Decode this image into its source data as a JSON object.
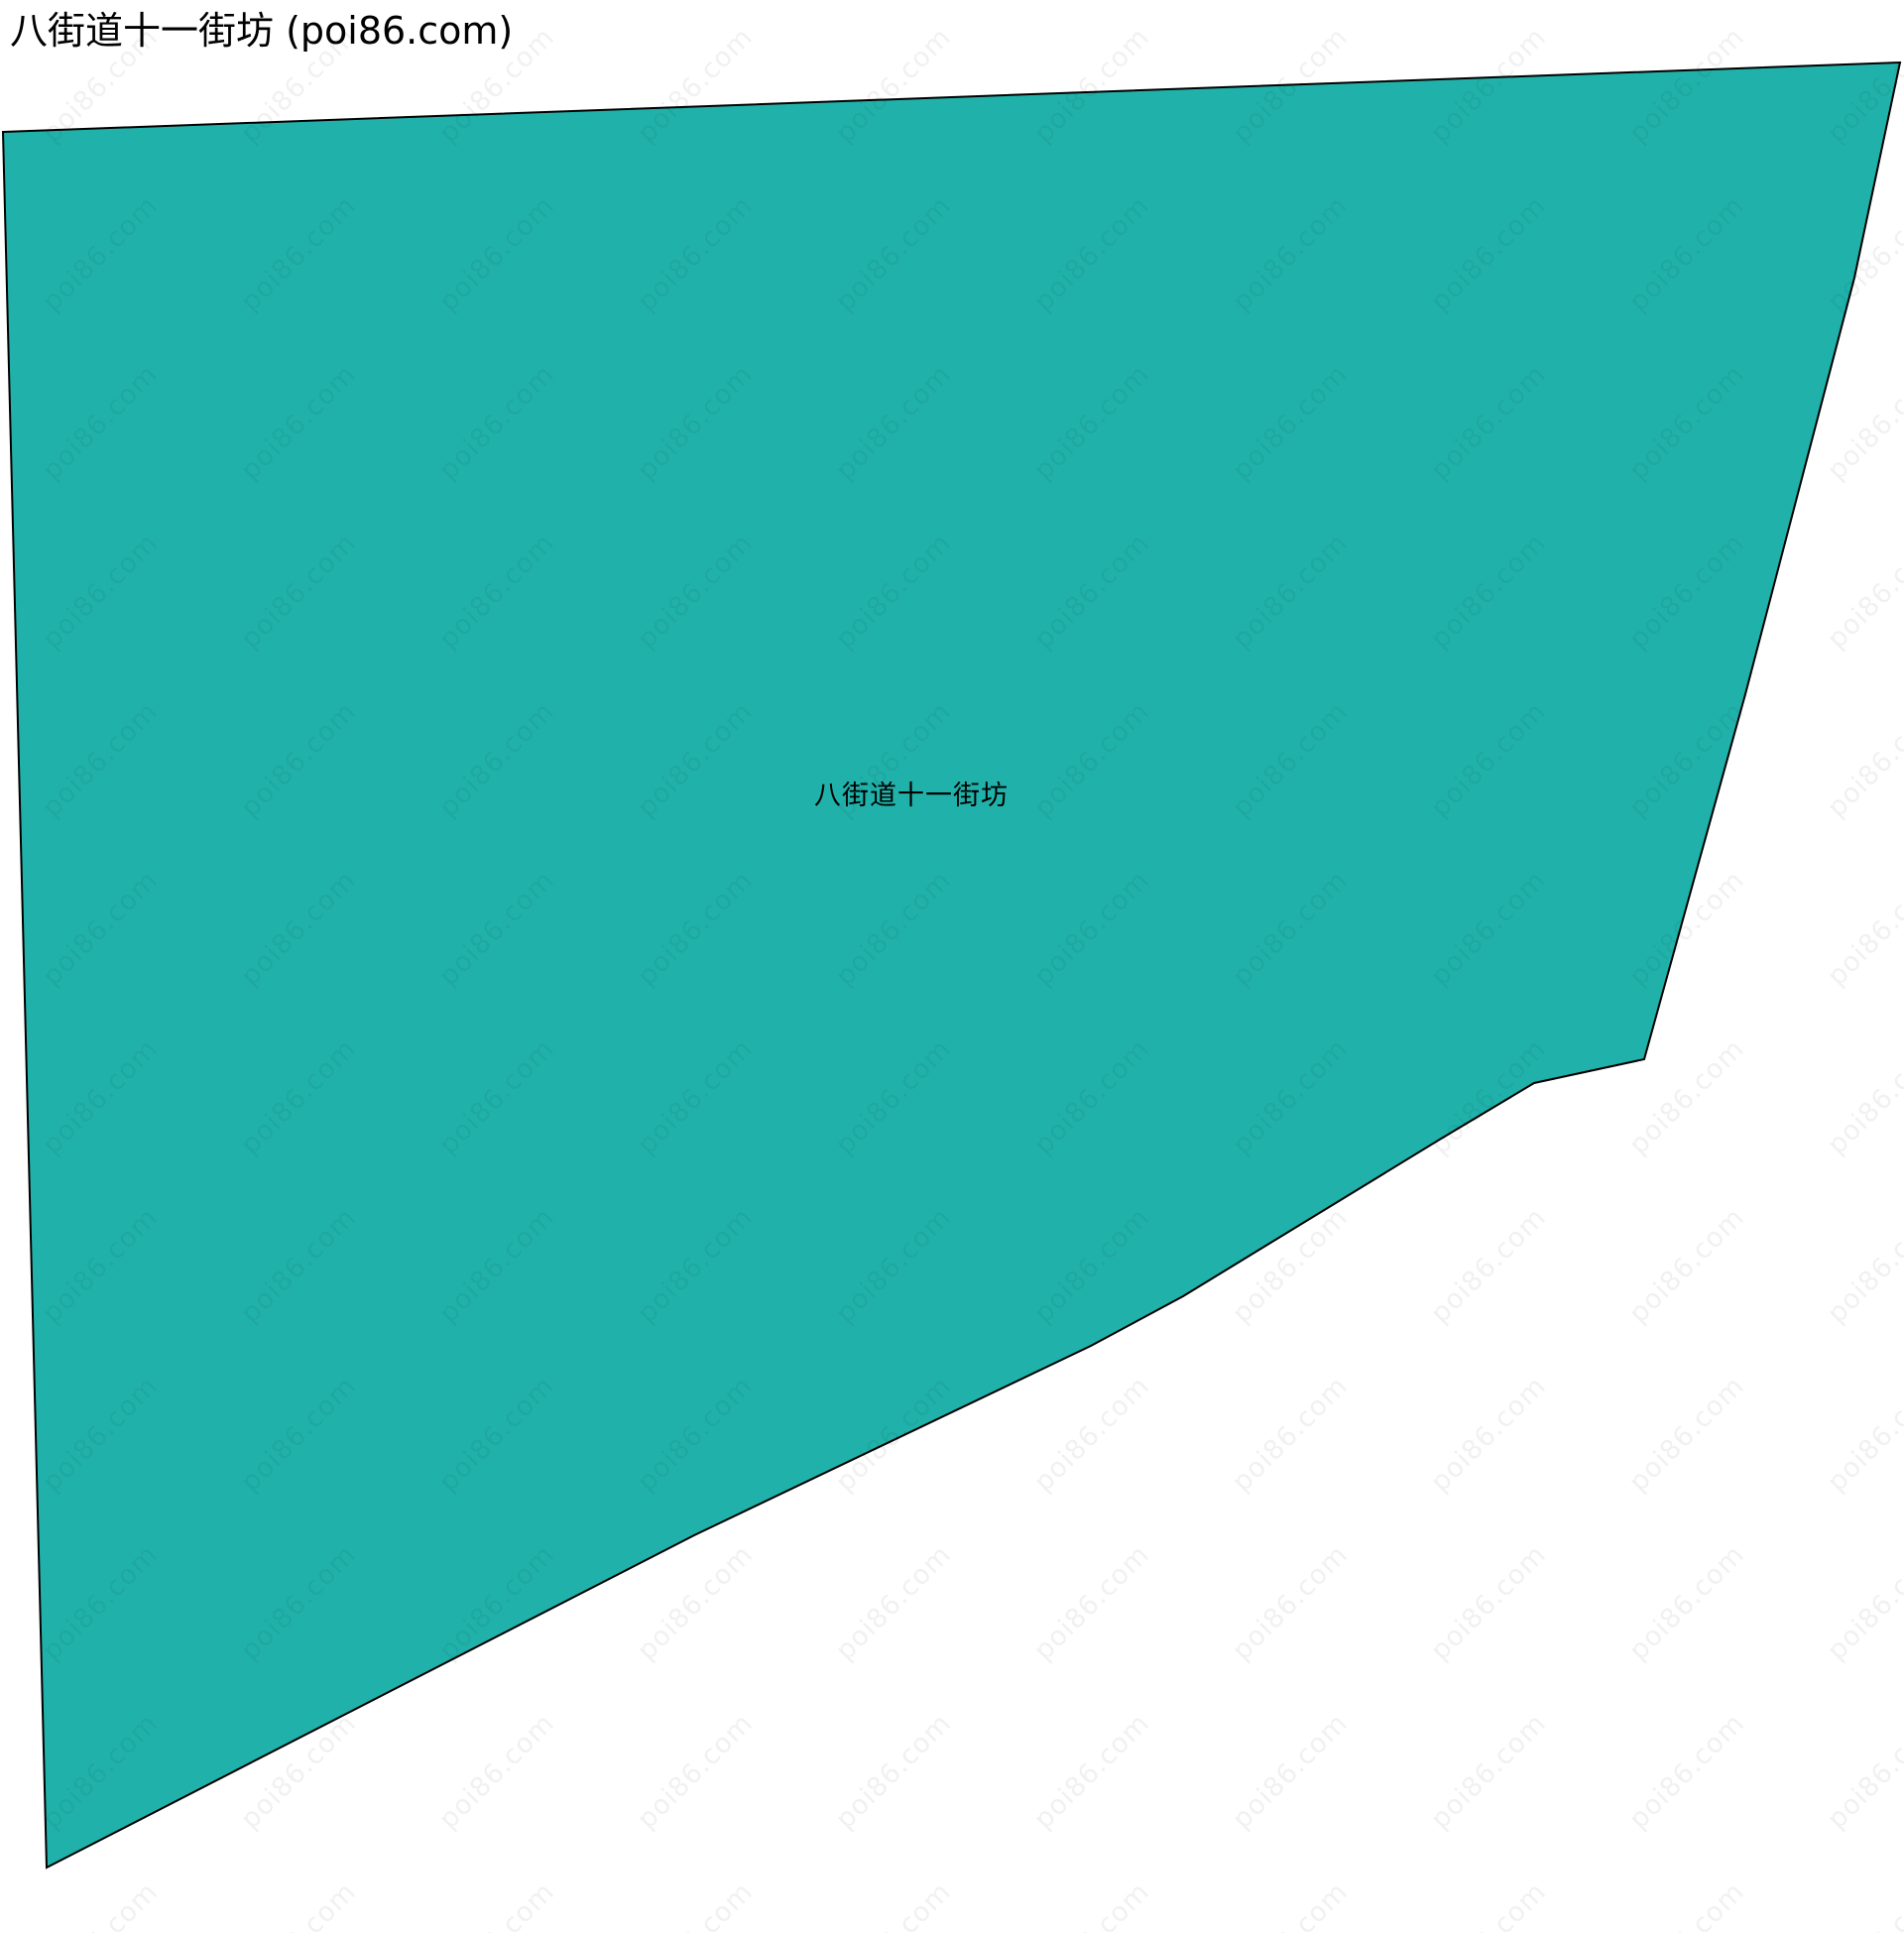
{
  "page": {
    "title": "八街道十一街坊 (poi86.com)",
    "background_color": "#ffffff"
  },
  "map": {
    "region_label": "八街道十一街坊",
    "fill_color": "#20b2aa",
    "stroke_color": "#000000",
    "stroke_width": "2",
    "canvas_width": "1920",
    "canvas_height": "1949",
    "polygon_points": "3,133 1916,63 1870,280 1760,700 1658,1068 1547,1092 1450,1150 1193,1307 1100,1357 700,1548 47,1883"
  },
  "watermark": {
    "text": "poi86.com",
    "color": "rgba(0,0,0,0.055)"
  }
}
